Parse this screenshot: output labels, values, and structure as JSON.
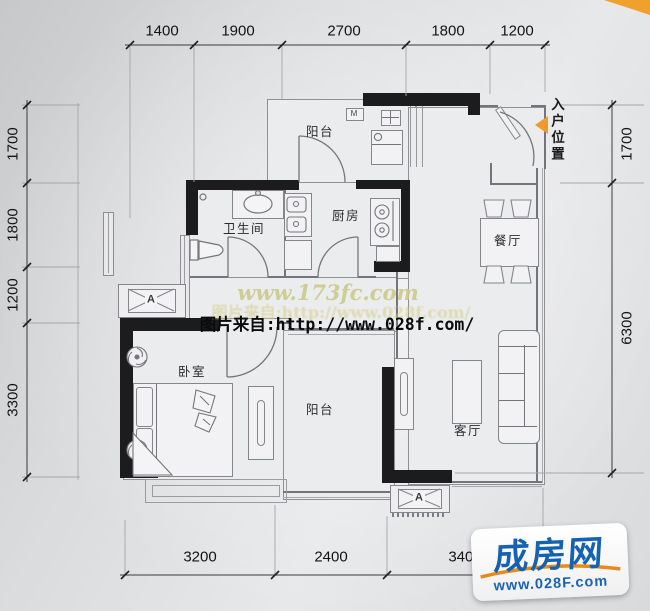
{
  "scene": {
    "type": "apartment-floor-plan"
  },
  "dimensions": {
    "top": [
      "1400",
      "1900",
      "2700",
      "1800",
      "1200"
    ],
    "left": [
      "1700",
      "1800",
      "1200",
      "3300"
    ],
    "right": [
      "1700",
      "6300"
    ],
    "bottom": [
      "3200",
      "2400",
      "3400"
    ]
  },
  "rooms": {
    "balcony_top": "阳台",
    "bathroom": "卫生间",
    "kitchen": "厨房",
    "dining": "餐厅",
    "bedroom": "卧室",
    "balcony_bottom": "阳台",
    "living": "客厅"
  },
  "annotations": {
    "entry": "入户位置",
    "ac_unit": "A",
    "washer": "M"
  },
  "watermarks": {
    "site": "www.173fc.com",
    "source": "图片来自:http://www.028f.com/"
  },
  "logo": {
    "name": "成房网",
    "url": "www.028F.com"
  },
  "colors": {
    "wall": "#1c1c1e",
    "accent_orange": "#f0a02c",
    "logo_blue": "#1562b2",
    "watermark_olive": "#cacA8c"
  }
}
